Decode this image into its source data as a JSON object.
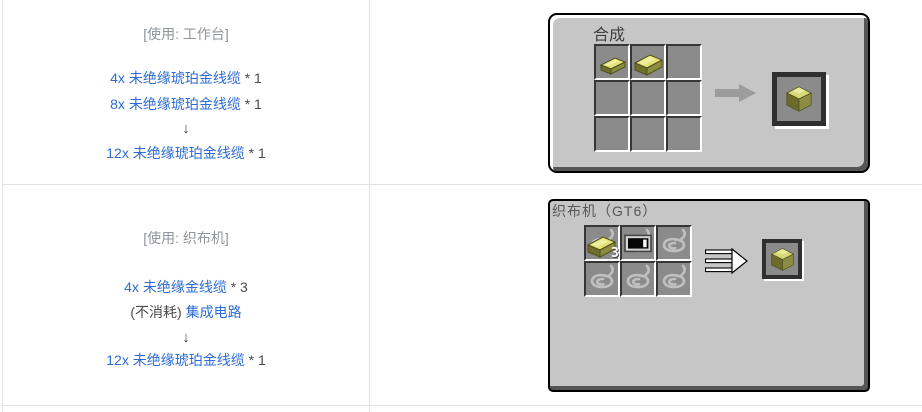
{
  "colors": {
    "link": "#2c6cd4",
    "muted_header": "#90949c",
    "body_text": "#4b4b4b",
    "table_border": "#e1e2e6",
    "panel_bg": "#c6c6c6",
    "slot_bg": "#8b8b8b",
    "slot_border_dark": "#363636",
    "cable_yellow_top": "#e2e275",
    "cable_olive_left": "#6f6f2b",
    "cable_olive_right": "#8d8d41",
    "result_arrow_gray": "#9c9c9c"
  },
  "icons": {
    "down-arrow": "↓",
    "crafting-result-arrow": "gray-right-arrow",
    "loom-result-arrow": "triple-line-right-arrow",
    "cable-item-small": "yellow-cable-ingot-small",
    "cable-item-large": "yellow-cable-ingot-large",
    "cable-block": "yellow-cable-block",
    "integrated-circuit": "black-chip-with-white-bar",
    "string-ghost": "gray-string-coil"
  },
  "rows": [
    {
      "station_header": "[使用: 工作台]",
      "inputs": [
        {
          "prefix": "",
          "link": "4x 未绝缘琥珀金线缆",
          "suffix": " * 1"
        },
        {
          "prefix": "",
          "link": "8x 未绝缘琥珀金线缆",
          "suffix": " * 1"
        }
      ],
      "down_arrow": "↓",
      "output": {
        "prefix": "",
        "link": "12x 未绝缘琥珀金线缆",
        "suffix": " * 1"
      },
      "panel": {
        "title": "合成",
        "grid": "3x3",
        "filled_slots": [
          "cable-item-small",
          "cable-item-large"
        ],
        "result_item": "cable-block"
      }
    },
    {
      "station_header": "[使用: 织布机]",
      "inputs": [
        {
          "prefix": "",
          "link": "4x 未绝缘金线缆",
          "suffix": " * 3"
        },
        {
          "prefix": "(不消耗) ",
          "link": "集成电路",
          "suffix": ""
        }
      ],
      "down_arrow": "↓",
      "output": {
        "prefix": "",
        "link": "12x 未绝缘琥珀金线缆",
        "suffix": " * 1"
      },
      "panel": {
        "title": "织布机（GT6）",
        "grid": "3x2",
        "slot_count": "3",
        "filled_slots": [
          "cable-item-large",
          "integrated-circuit"
        ],
        "ghost_slots": "string-ghost",
        "result_item": "cable-block"
      }
    }
  ]
}
